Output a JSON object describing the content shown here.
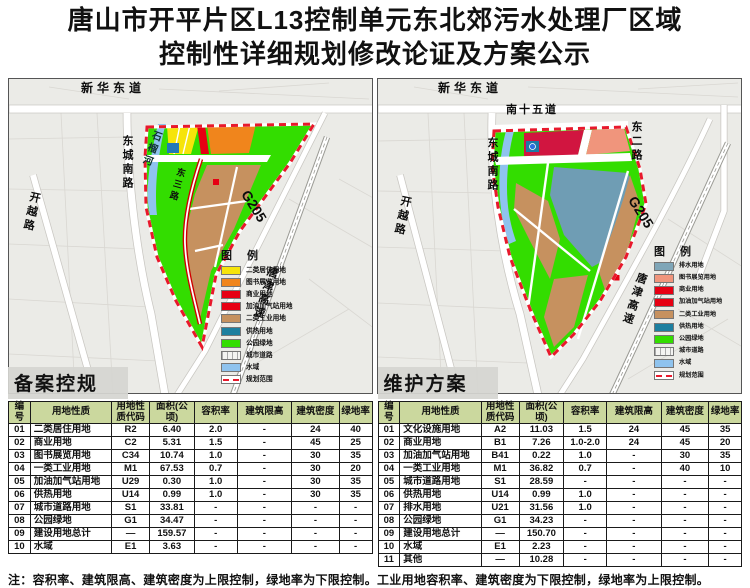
{
  "title": {
    "line1": "唐山市开平片区L13控制单元东北郊污水处理厂区域",
    "line2": "控制性详细规划修改论证及方案公示"
  },
  "maps": {
    "left": {
      "labels": {
        "top_road": "新华东道",
        "west_road": "东城南路",
        "river": "石榴河",
        "southwest_road": "开越路",
        "inner_road": "东三路",
        "g205": "G205",
        "expressway": "唐津高速"
      },
      "legend": {
        "title": "图  例",
        "items": [
          {
            "label": "二类居住用地",
            "color": "#f6e40a",
            "style": "fill"
          },
          {
            "label": "图书展览用地",
            "color": "#f0851c",
            "style": "fill"
          },
          {
            "label": "商业用地",
            "color": "#e60013",
            "style": "fill"
          },
          {
            "label": "加油加气站用地",
            "color": "#e60013",
            "style": "fill"
          },
          {
            "label": "二类工业用地",
            "color": "#c6915f",
            "style": "fill"
          },
          {
            "label": "供热用地",
            "color": "#1d7f9f",
            "style": "fill"
          },
          {
            "label": "公园绿地",
            "color": "#33dd00",
            "style": "fill"
          },
          {
            "label": "城市道路",
            "color": "#f4f4f2",
            "style": "hatch"
          },
          {
            "label": "水域",
            "color": "#8fc3ee",
            "style": "fill"
          },
          {
            "label": "规划范围",
            "color": "#e8192c",
            "style": "dash"
          }
        ]
      }
    },
    "right": {
      "labels": {
        "top_road": "新华东道",
        "north_road": "南十五道",
        "east_road": "东二路",
        "west_road": "东城南路",
        "southwest_road": "开越路",
        "g205": "G205",
        "expressway": "唐津高速"
      },
      "legend": {
        "title": "图  例",
        "items": [
          {
            "label": "排水用地",
            "color": "#7fa6b8",
            "style": "fill"
          },
          {
            "label": "图书展览用地",
            "color": "#f0957c",
            "style": "fill"
          },
          {
            "label": "商业用地",
            "color": "#e60013",
            "style": "fill"
          },
          {
            "label": "加油加气站用地",
            "color": "#e60013",
            "style": "fill"
          },
          {
            "label": "二类工业用地",
            "color": "#c6915f",
            "style": "fill"
          },
          {
            "label": "供热用地",
            "color": "#1d7f9f",
            "style": "fill"
          },
          {
            "label": "公园绿地",
            "color": "#33dd00",
            "style": "fill"
          },
          {
            "label": "城市道路",
            "color": "#f4f4f2",
            "style": "hatch"
          },
          {
            "label": "水域",
            "color": "#8fc3ee",
            "style": "fill"
          },
          {
            "label": "规划范围",
            "color": "#e8192c",
            "style": "dash"
          }
        ]
      }
    },
    "boundary_color": "#e8192c"
  },
  "tables": {
    "left": {
      "title": "备案控规",
      "headers": [
        "编号",
        "用地性质",
        "用地性质代码",
        "面积(公顷)",
        "容积率",
        "建筑限高",
        "建筑密度",
        "绿地率"
      ],
      "rows": [
        [
          "01",
          "二类居住用地",
          "R2",
          "6.40",
          "2.0",
          "-",
          "24",
          "40"
        ],
        [
          "02",
          "商业用地",
          "C2",
          "5.31",
          "1.5",
          "-",
          "45",
          "25"
        ],
        [
          "03",
          "图书展览用地",
          "C34",
          "10.74",
          "1.0",
          "-",
          "30",
          "35"
        ],
        [
          "04",
          "一类工业用地",
          "M1",
          "67.53",
          "0.7",
          "-",
          "30",
          "20"
        ],
        [
          "05",
          "加油加气站用地",
          "U29",
          "0.30",
          "1.0",
          "-",
          "30",
          "35"
        ],
        [
          "06",
          "供热用地",
          "U14",
          "0.99",
          "1.0",
          "-",
          "30",
          "35"
        ],
        [
          "07",
          "城市道路用地",
          "S1",
          "33.81",
          "-",
          "-",
          "-",
          "-"
        ],
        [
          "08",
          "公园绿地",
          "G1",
          "34.47",
          "-",
          "-",
          "-",
          "-"
        ],
        [
          "09",
          "建设用地总计",
          "—",
          "159.57",
          "-",
          "-",
          "-",
          "-"
        ],
        [
          "10",
          "水域",
          "E1",
          "3.63",
          "-",
          "-",
          "-",
          "-"
        ]
      ]
    },
    "right": {
      "title": "维护方案",
      "headers": [
        "编号",
        "用地性质",
        "用地性质代码",
        "面积(公顷)",
        "容积率",
        "建筑限高",
        "建筑密度",
        "绿地率"
      ],
      "rows": [
        [
          "01",
          "文化设施用地",
          "A2",
          "11.03",
          "1.5",
          "24",
          "45",
          "35"
        ],
        [
          "02",
          "商业用地",
          "B1",
          "7.26",
          "1.0-2.0",
          "24",
          "45",
          "20"
        ],
        [
          "03",
          "加油加气站用地",
          "B41",
          "0.22",
          "1.0",
          "-",
          "30",
          "35"
        ],
        [
          "04",
          "一类工业用地",
          "M1",
          "36.82",
          "0.7",
          "-",
          "40",
          "10"
        ],
        [
          "05",
          "城市道路用地",
          "S1",
          "28.59",
          "-",
          "-",
          "-",
          "-"
        ],
        [
          "06",
          "供热用地",
          "U14",
          "0.99",
          "1.0",
          "-",
          "-",
          "-"
        ],
        [
          "07",
          "排水用地",
          "U21",
          "31.56",
          "1.0",
          "-",
          "-",
          "-"
        ],
        [
          "08",
          "公园绿地",
          "G1",
          "34.23",
          "-",
          "-",
          "-",
          "-"
        ],
        [
          "09",
          "建设用地总计",
          "—",
          "150.70",
          "-",
          "-",
          "-",
          "-"
        ],
        [
          "10",
          "水域",
          "E1",
          "2.23",
          "-",
          "-",
          "-",
          "-"
        ],
        [
          "11",
          "其他",
          "—",
          "10.28",
          "-",
          "-",
          "-",
          "-"
        ]
      ]
    }
  },
  "note": "注：容积率、建筑限高、建筑密度为上限控制，绿地率为下限控制。工业用地容积率、建筑密度为下限控制，绿地率为上限控制。"
}
